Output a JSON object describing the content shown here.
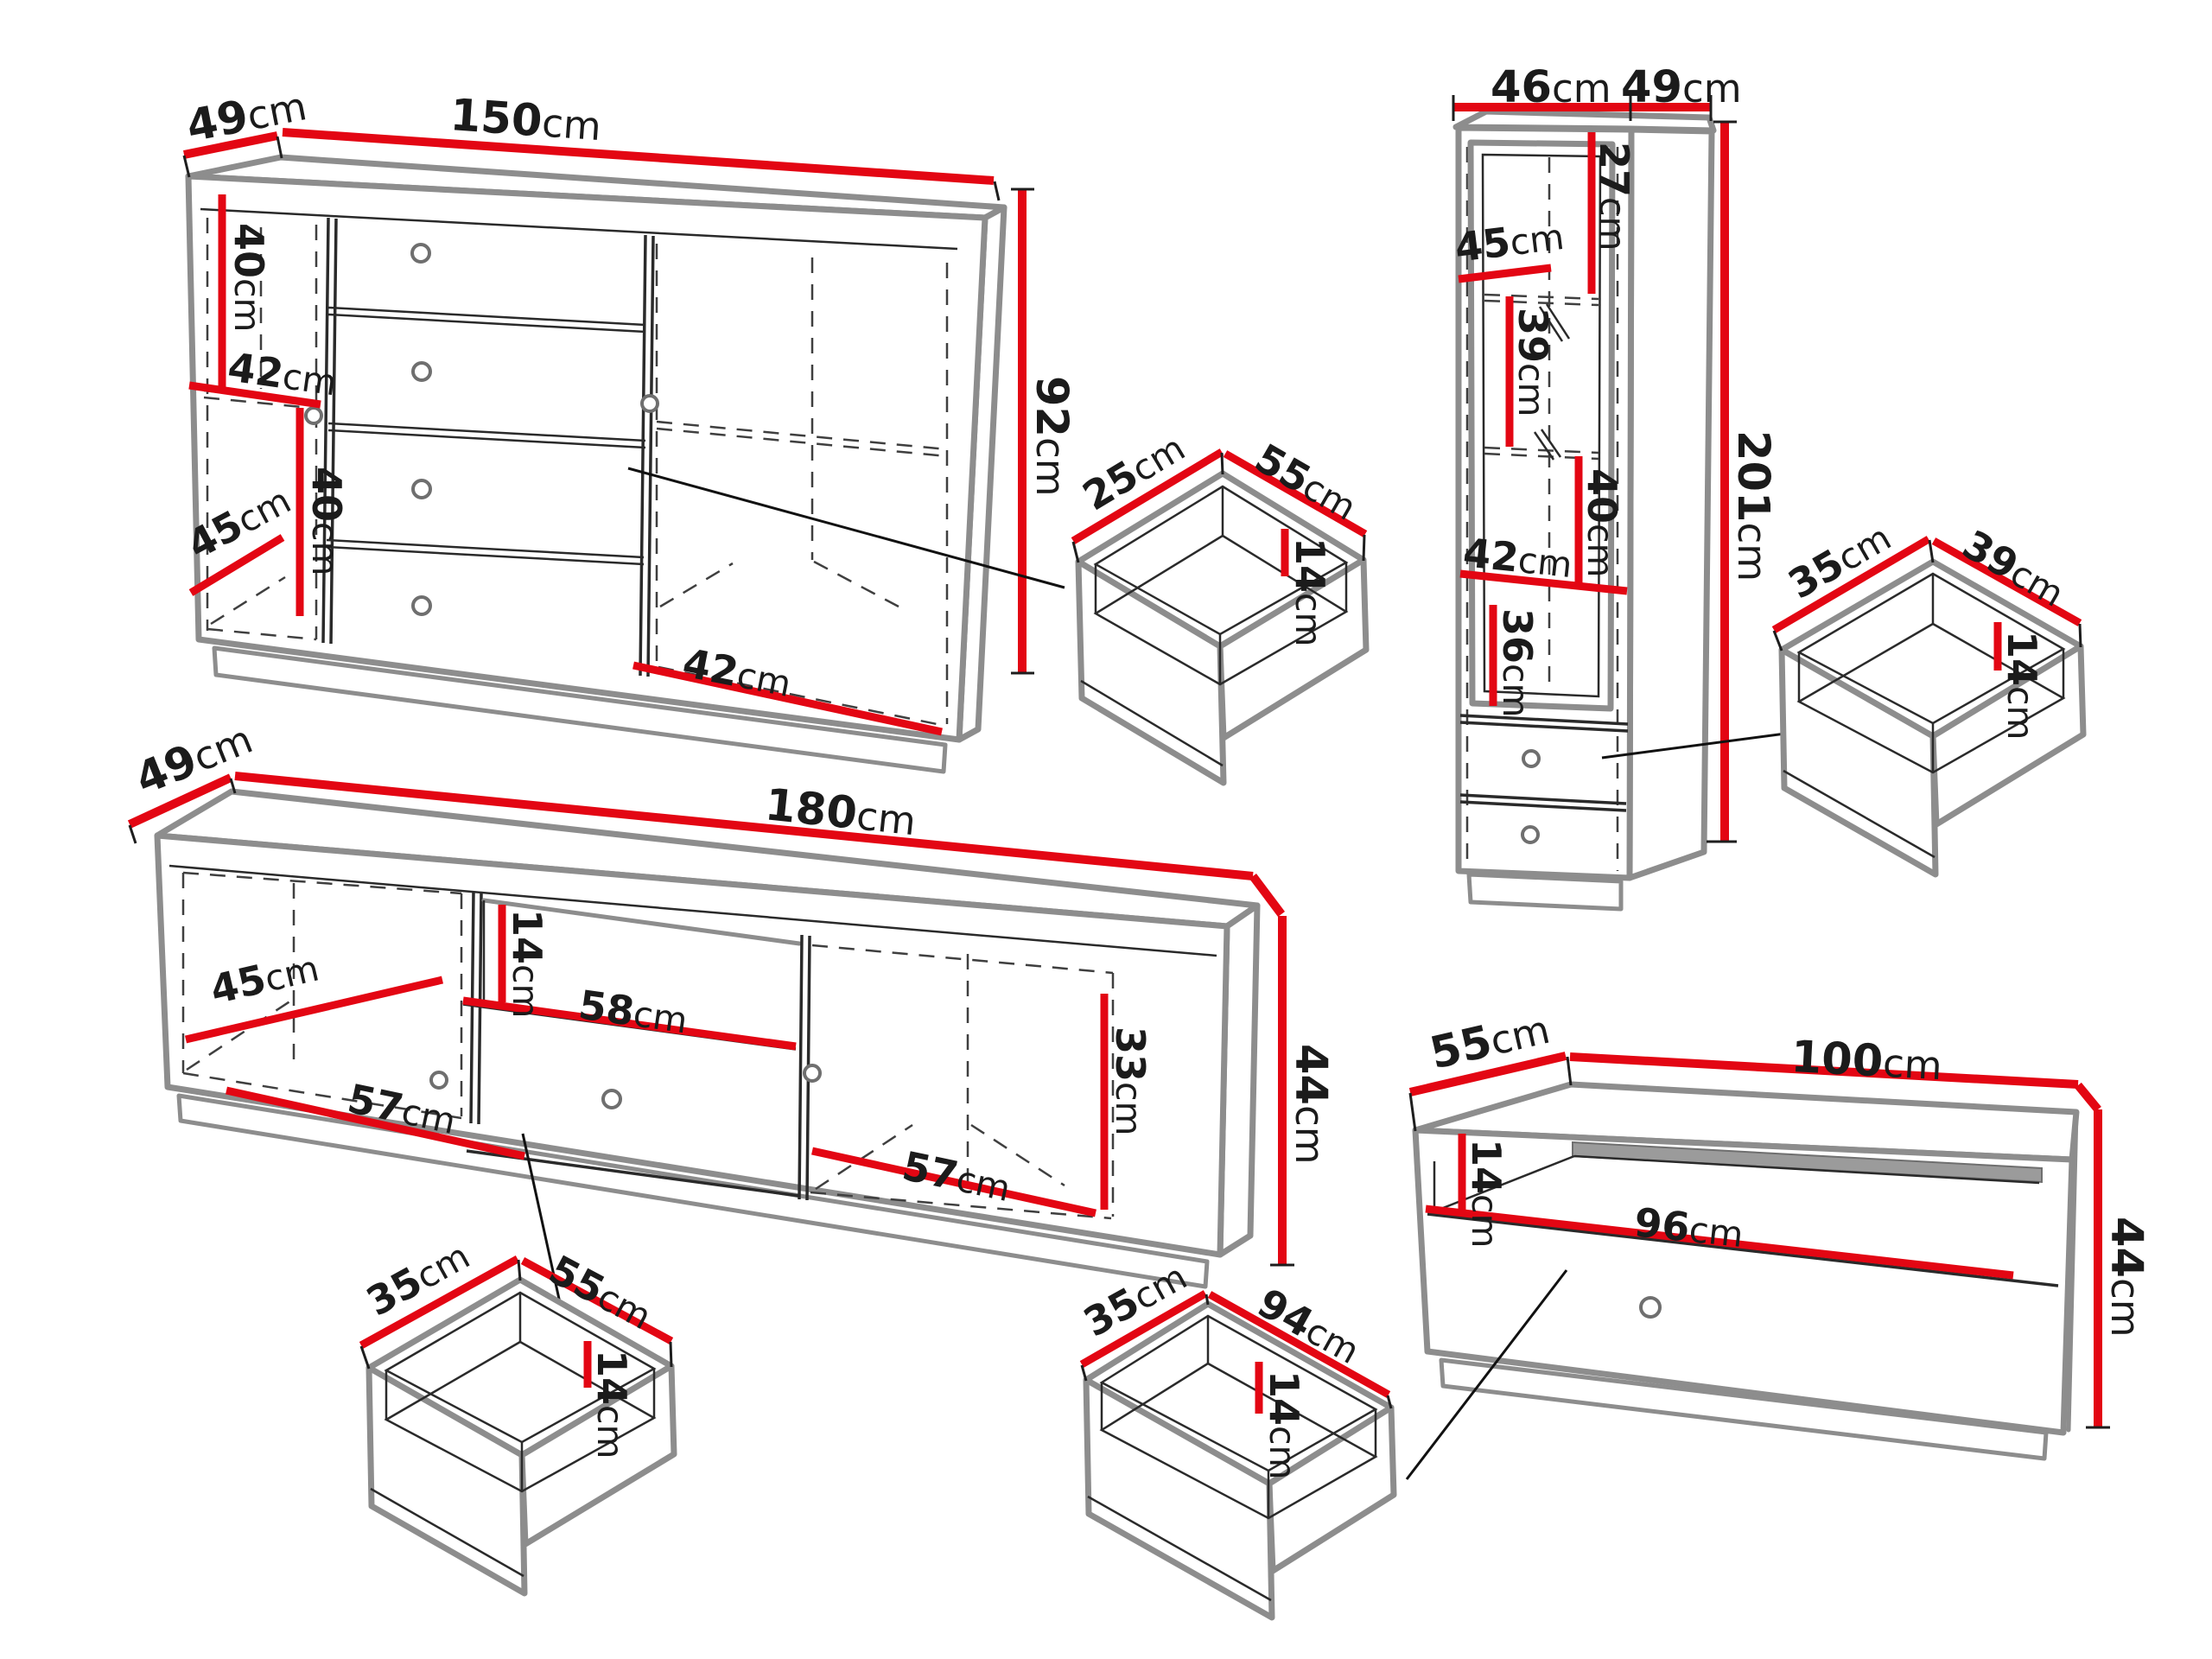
{
  "diagram": {
    "type": "furniture-dimension-diagram",
    "unit": "cm",
    "colors": {
      "dimension_line": "#e30613",
      "outline": "#8d8d8d",
      "text": "#1b1b1b"
    },
    "pieces": {
      "sideboard": {
        "name": "sideboard-150",
        "labels": {
          "depth": {
            "v": "49",
            "u": "cm"
          },
          "width": {
            "v": "150",
            "u": "cm"
          },
          "height": {
            "v": "92",
            "u": "cm"
          },
          "upper_section_height": {
            "v": "40",
            "u": "cm"
          },
          "left_shelf_width": {
            "v": "42",
            "u": "cm"
          },
          "lower_section_height": {
            "v": "40",
            "u": "cm"
          },
          "inner_depth": {
            "v": "45",
            "u": "cm"
          },
          "right_compartment_width": {
            "v": "42",
            "u": "cm"
          }
        }
      },
      "small_drawer": {
        "name": "drawer-55x25",
        "labels": {
          "depth": {
            "v": "25",
            "u": "cm"
          },
          "width": {
            "v": "55",
            "u": "cm"
          },
          "height": {
            "v": "14",
            "u": "cm"
          }
        }
      },
      "tall_cabinet": {
        "name": "tall-cabinet-201",
        "labels": {
          "width": {
            "v": "46",
            "u": "cm"
          },
          "depth": {
            "v": "49",
            "u": "cm"
          },
          "top_section_height": {
            "v": "27",
            "u": "cm"
          },
          "inner_depth": {
            "v": "45",
            "u": "cm"
          },
          "second_section_height": {
            "v": "39",
            "u": "cm"
          },
          "third_section_height": {
            "v": "40",
            "u": "cm"
          },
          "inner_width": {
            "v": "42",
            "u": "cm"
          },
          "fourth_section_height": {
            "v": "36",
            "u": "cm"
          },
          "height": {
            "v": "201",
            "u": "cm"
          }
        }
      },
      "side_drawer": {
        "name": "drawer-39x35",
        "labels": {
          "depth": {
            "v": "35",
            "u": "cm"
          },
          "width": {
            "v": "39",
            "u": "cm"
          },
          "height": {
            "v": "14",
            "u": "cm"
          }
        }
      },
      "tv_stand": {
        "name": "tv-stand-180",
        "labels": {
          "depth": {
            "v": "49",
            "u": "cm"
          },
          "width": {
            "v": "180",
            "u": "cm"
          },
          "inner_depth": {
            "v": "45",
            "u": "cm"
          },
          "left_compartment_width": {
            "v": "57",
            "u": "cm"
          },
          "niche_height": {
            "v": "14",
            "u": "cm"
          },
          "niche_width": {
            "v": "58",
            "u": "cm"
          },
          "right_compartment_height": {
            "v": "33",
            "u": "cm"
          },
          "right_compartment_width": {
            "v": "57",
            "u": "cm"
          },
          "height": {
            "v": "44",
            "u": "cm"
          }
        }
      },
      "bottom_drawer_small": {
        "name": "drawer-55x35",
        "labels": {
          "depth": {
            "v": "35",
            "u": "cm"
          },
          "width": {
            "v": "55",
            "u": "cm"
          },
          "height": {
            "v": "14",
            "u": "cm"
          }
        }
      },
      "bottom_drawer_wide": {
        "name": "drawer-94x35",
        "labels": {
          "depth": {
            "v": "35",
            "u": "cm"
          },
          "width": {
            "v": "94",
            "u": "cm"
          },
          "height": {
            "v": "14",
            "u": "cm"
          }
        }
      },
      "tv_cabinet": {
        "name": "tv-cabinet-100",
        "labels": {
          "depth": {
            "v": "55",
            "u": "cm"
          },
          "width": {
            "v": "100",
            "u": "cm"
          },
          "niche_height": {
            "v": "14",
            "u": "cm"
          },
          "niche_width": {
            "v": "96",
            "u": "cm"
          },
          "height": {
            "v": "44",
            "u": "cm"
          }
        }
      }
    }
  }
}
